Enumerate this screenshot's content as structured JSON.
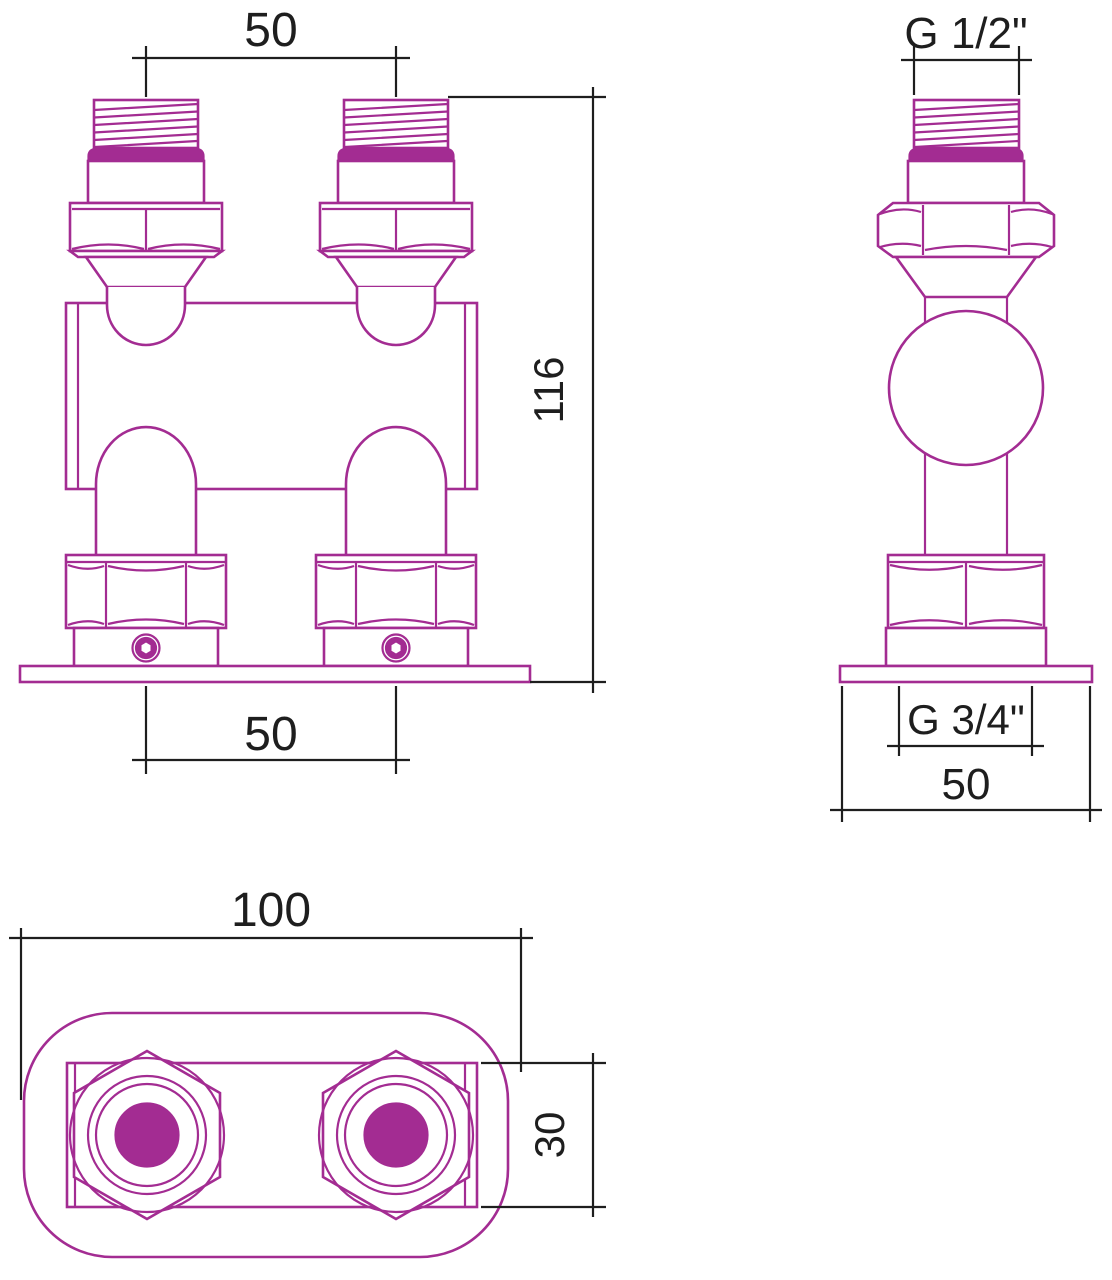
{
  "document": {
    "type": "technical-drawing",
    "subject": "dual-port radiator valve manifold fitting, three orthographic views"
  },
  "colors": {
    "outline": "#A32C92",
    "dimension": "#1E1E1E",
    "background": "#FFFFFF"
  },
  "views": {
    "front": {
      "label": "front-view",
      "dims": {
        "top_spacing": "50",
        "height": "116",
        "bottom_spacing": "50"
      }
    },
    "side": {
      "label": "side-view",
      "dims": {
        "top_thread": "G 1/2\"",
        "bottom_thread": "G 3/4\"",
        "base_width": "50"
      }
    },
    "bottom": {
      "label": "bottom-view",
      "dims": {
        "plate_width": "100",
        "body_depth": "30"
      }
    }
  }
}
